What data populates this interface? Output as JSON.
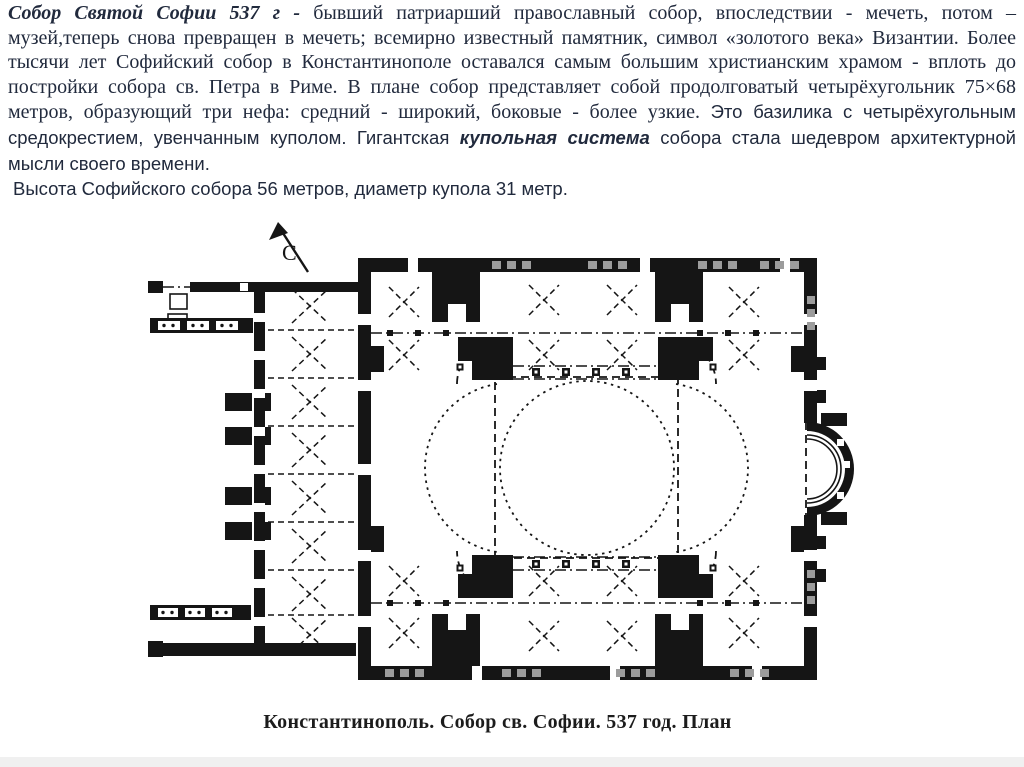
{
  "slide": {
    "intro": {
      "lead": "Собор Святой Софии 537 г - ",
      "body_serif": "бывший патриарший православный собор, впоследствии - мечеть, потом – музей,теперь снова превращен в мечеть; всемирно известный памятник, символ «золотого века» Византии. Более тысячи лет Софийский собор в Константинополе оставался самым большим христианским храмом - вплоть до постройки собора св. Петра в Риме. В плане собор представляет собой продолговатый четырёхугольник 75×68 метров, образующий три нефа: средний - широкий, боковые - более узкие. ",
      "body_sans_1": "Это базилика с четырёхугольным средокрестием, увенчанным куполом. Гигантская ",
      "emphasis": "купольная система",
      "body_sans_2": " собора стала шедевром архитектурной мысли своего времени.",
      "second_line": "Высота Софийского собора 56 метров, диаметр купола 31 метр."
    },
    "plan": {
      "north_label": "С",
      "caption": "Константинополь. Собор св. Софии. 537 год. План"
    },
    "colors": {
      "intro_text": "#212a3d",
      "caption_text": "#1c1c1c",
      "plan_ink": "#151515",
      "footer_bar": "#f0f0f0",
      "background": "#ffffff"
    }
  }
}
